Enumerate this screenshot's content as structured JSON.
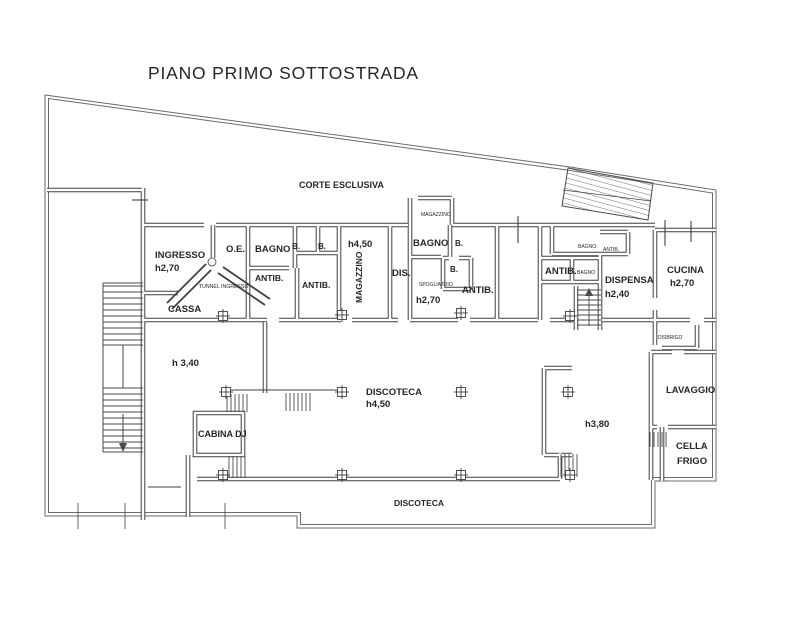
{
  "title": {
    "text": "PIANO PRIMO SOTTOSTRADA"
  },
  "colors": {
    "background": "#ffffff",
    "ink": "#3f3f3f",
    "boundary": "#6a6a6a",
    "text": "#262626"
  },
  "floorplan": {
    "plan_type": "architectural floor plan",
    "labels": [
      {
        "id": "corte-esclusiva",
        "text": "CORTE ESCLUSIVA",
        "x": 299,
        "y": 188,
        "size": 9,
        "w": 700
      },
      {
        "id": "ingresso",
        "text": "INGRESSO",
        "x": 155,
        "y": 258,
        "size": 9.5,
        "w": 700
      },
      {
        "id": "ingresso-height",
        "text": "h2,70",
        "x": 155,
        "y": 271,
        "size": 9.5,
        "w": 700
      },
      {
        "id": "oe-room",
        "text": "O.E.",
        "x": 226,
        "y": 252,
        "size": 9.5,
        "w": 700
      },
      {
        "id": "tunnel-ingresso",
        "text": "TUNNEL INGRESSO",
        "x": 199,
        "y": 288,
        "size": 5.2,
        "w": 400
      },
      {
        "id": "cassa",
        "text": "CASSA",
        "x": 168,
        "y": 312,
        "size": 9.5,
        "w": 700
      },
      {
        "id": "cassa-height",
        "text": "h 3,40",
        "x": 172,
        "y": 366,
        "size": 9.5,
        "w": 700
      },
      {
        "id": "bagno-a",
        "text": "BAGNO",
        "x": 255,
        "y": 252,
        "size": 9.5,
        "w": 700
      },
      {
        "id": "b-a1",
        "text": "B.",
        "x": 292,
        "y": 249,
        "size": 8,
        "w": 700
      },
      {
        "id": "b-a2",
        "text": "B.",
        "x": 318,
        "y": 249,
        "size": 8,
        "w": 700
      },
      {
        "id": "antib-a1",
        "text": "ANTIB.",
        "x": 255,
        "y": 281,
        "size": 8.5,
        "w": 700
      },
      {
        "id": "antib-a2",
        "text": "ANTIB.",
        "x": 302,
        "y": 288,
        "size": 8.5,
        "w": 700
      },
      {
        "id": "magazzino-height",
        "text": "h4,50",
        "x": 348,
        "y": 247,
        "size": 9.5,
        "w": 700
      },
      {
        "id": "magazzino-vertical",
        "text": "MAGAZZINO",
        "x": 362,
        "y": 303,
        "size": 8.5,
        "w": 700,
        "rotate": -90
      },
      {
        "id": "dis",
        "text": "DIS.",
        "x": 392,
        "y": 276,
        "size": 9.5,
        "w": 700
      },
      {
        "id": "magazzino-small",
        "text": "MAGAZZINO",
        "x": 421,
        "y": 216,
        "size": 5,
        "w": 400
      },
      {
        "id": "bagno-b",
        "text": "BAGNO",
        "x": 413,
        "y": 246,
        "size": 9.5,
        "w": 700
      },
      {
        "id": "b-b1",
        "text": "B.",
        "x": 455,
        "y": 246,
        "size": 8,
        "w": 700
      },
      {
        "id": "b-b2",
        "text": "B.",
        "x": 450,
        "y": 272,
        "size": 8,
        "w": 700
      },
      {
        "id": "spogliatoio",
        "text": "SPOGLIATOIO",
        "x": 419,
        "y": 286,
        "size": 5,
        "w": 400
      },
      {
        "id": "spogliatoio-height",
        "text": "h2,70",
        "x": 416,
        "y": 303,
        "size": 9.5,
        "w": 700
      },
      {
        "id": "antib-b",
        "text": "ANTIB.",
        "x": 462,
        "y": 293,
        "size": 9.5,
        "w": 700
      },
      {
        "id": "bagno-c1",
        "text": "BAGNO",
        "x": 578,
        "y": 248,
        "size": 5,
        "w": 400
      },
      {
        "id": "antib-c1",
        "text": "ANTIB.",
        "x": 603,
        "y": 251,
        "size": 5,
        "w": 400
      },
      {
        "id": "antib-c",
        "text": "ANTIB.",
        "x": 545,
        "y": 274,
        "size": 9.5,
        "w": 700
      },
      {
        "id": "bagno-c2",
        "text": "BAGNO",
        "x": 577,
        "y": 274,
        "size": 5,
        "w": 400
      },
      {
        "id": "dispensa",
        "text": "DISPENSA",
        "x": 605,
        "y": 283,
        "size": 9.5,
        "w": 700
      },
      {
        "id": "dispensa-height",
        "text": "h2,40",
        "x": 605,
        "y": 297,
        "size": 9.5,
        "w": 700
      },
      {
        "id": "cucina",
        "text": "CUCINA",
        "x": 667,
        "y": 273,
        "size": 9.5,
        "w": 700
      },
      {
        "id": "cucina-height",
        "text": "h2,70",
        "x": 670,
        "y": 286,
        "size": 9.5,
        "w": 700
      },
      {
        "id": "disbrigo",
        "text": "DISBRIGO",
        "x": 658,
        "y": 339,
        "size": 5,
        "w": 400
      },
      {
        "id": "lavaggio",
        "text": "LAVAGGIO",
        "x": 666,
        "y": 393,
        "size": 9.5,
        "w": 700
      },
      {
        "id": "cella",
        "text": "CELLA",
        "x": 676,
        "y": 449,
        "size": 9.5,
        "w": 700
      },
      {
        "id": "frigo",
        "text": "FRIGO",
        "x": 677,
        "y": 464,
        "size": 9.5,
        "w": 700
      },
      {
        "id": "cabina-dj",
        "text": "CABINA DJ",
        "x": 198,
        "y": 437,
        "size": 9,
        "w": 700
      },
      {
        "id": "discoteca-main",
        "text": "DISCOTECA",
        "x": 366,
        "y": 395,
        "size": 9.5,
        "w": 700
      },
      {
        "id": "discoteca-height",
        "text": "h4,50",
        "x": 366,
        "y": 407,
        "size": 9.5,
        "w": 700
      },
      {
        "id": "sala-height",
        "text": "h3,80",
        "x": 585,
        "y": 427,
        "size": 9.5,
        "w": 700
      },
      {
        "id": "discoteca-bottom",
        "text": "DISCOTECA",
        "x": 394,
        "y": 506,
        "size": 8.5,
        "w": 700
      }
    ],
    "columns": [
      {
        "x": 223,
        "y": 316
      },
      {
        "x": 342,
        "y": 315
      },
      {
        "x": 461,
        "y": 313
      },
      {
        "x": 570,
        "y": 316
      },
      {
        "x": 226,
        "y": 392
      },
      {
        "x": 342,
        "y": 392
      },
      {
        "x": 461,
        "y": 392
      },
      {
        "x": 568,
        "y": 392
      },
      {
        "x": 223,
        "y": 475
      },
      {
        "x": 342,
        "y": 475
      },
      {
        "x": 461,
        "y": 475
      },
      {
        "x": 570,
        "y": 475
      }
    ]
  }
}
